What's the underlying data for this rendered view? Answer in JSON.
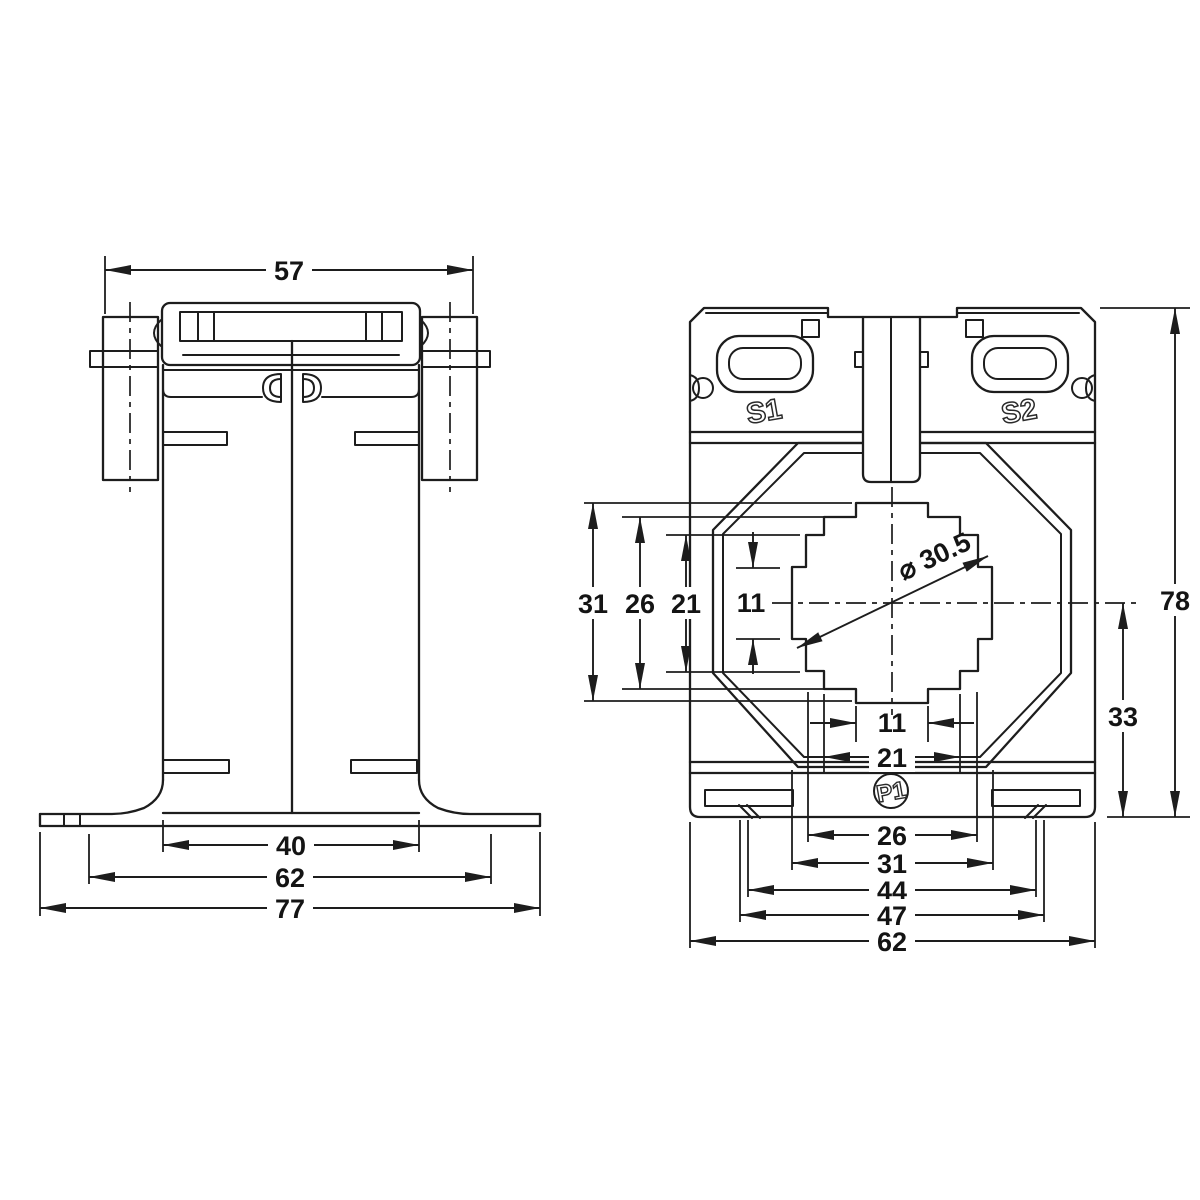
{
  "drawing": {
    "background": "#ffffff",
    "line_color": "#1d1d1d",
    "side_view": {
      "dim_top_width": "57",
      "dim_body_width": "40",
      "dim_slot_span": "62",
      "dim_overall_width": "77"
    },
    "front_view": {
      "terminal_labels": {
        "s1": "S1",
        "s2": "S2",
        "p1": "P1"
      },
      "left_dims": [
        "31",
        "26",
        "21"
      ],
      "left_inner_dim": "11",
      "bore_dim": "⌀ 30.5",
      "bottom_inner_dims": [
        "11",
        "21"
      ],
      "bottom_dims": [
        "26",
        "31",
        "44",
        "47",
        "62"
      ],
      "dim_overall_height": "78",
      "dim_center_to_base": "33"
    }
  }
}
